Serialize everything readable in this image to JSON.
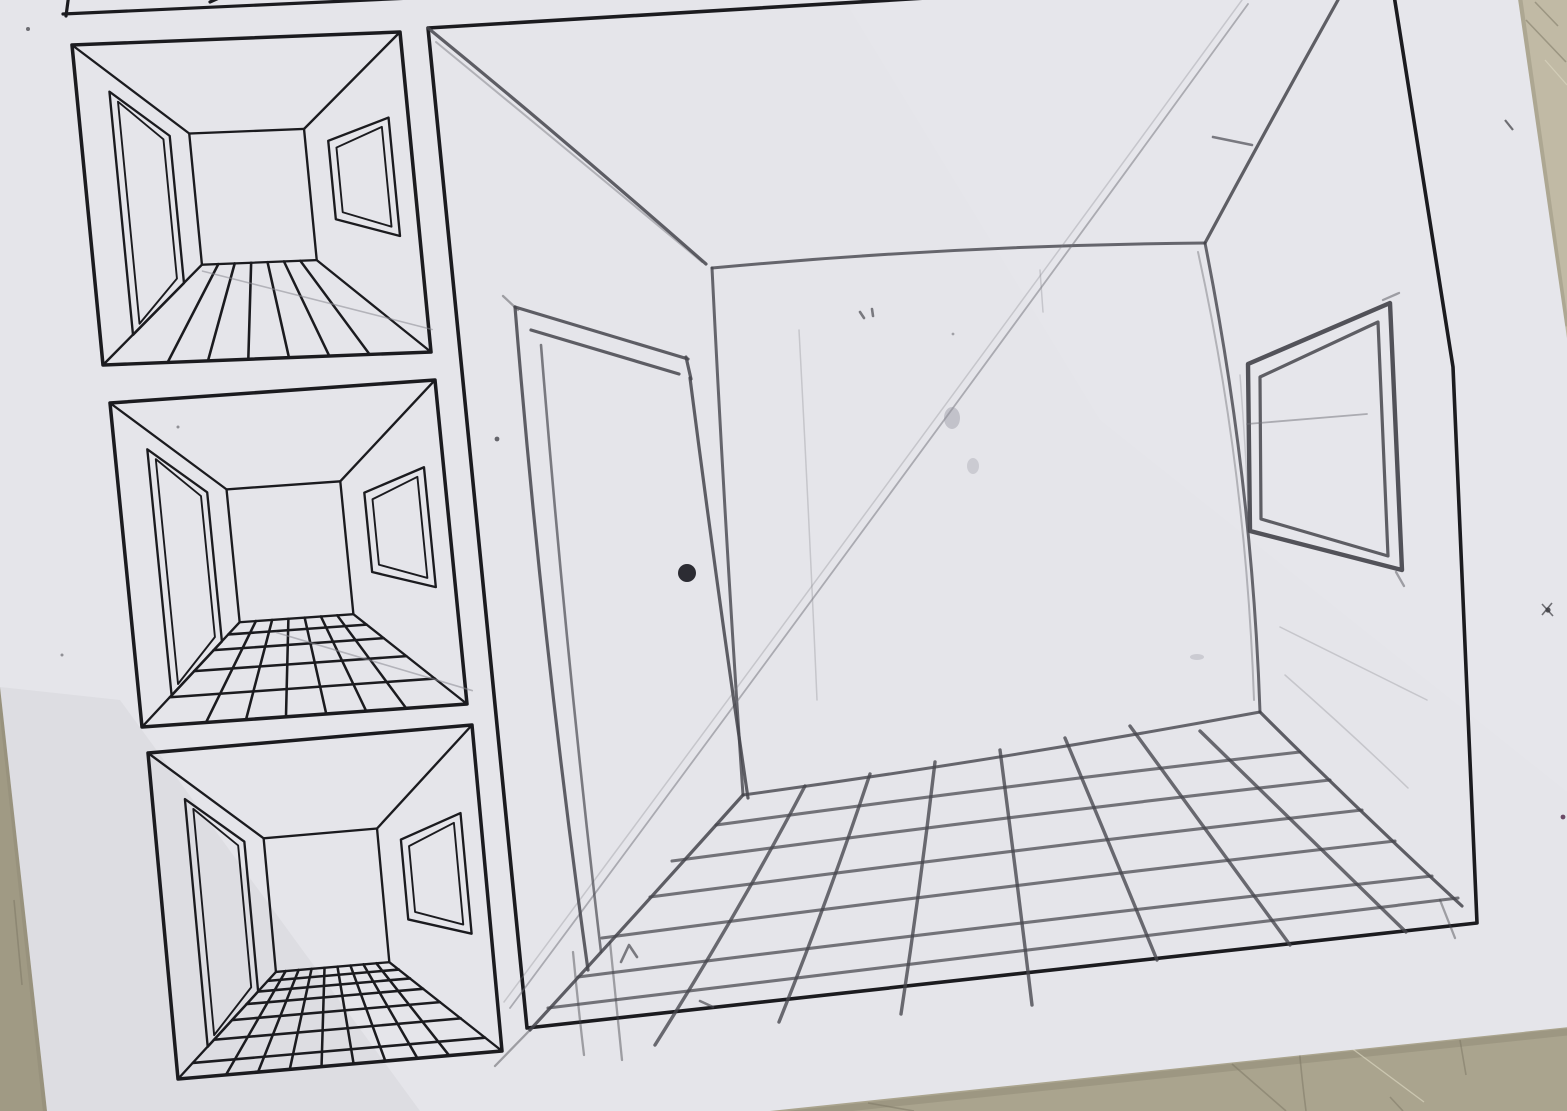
{
  "scene": {
    "description": "Photograph of a one-point perspective drawing worksheet lying on a table",
    "medium": "pencil on printed worksheet",
    "visible_text": ""
  },
  "colors": {
    "table": "#b7b19b",
    "table_dark": "#a09a84",
    "paper": "#e5e5ea",
    "paper_bright": "#eeeef2",
    "printed_ink": "#1b1b1f",
    "pencil": "#45454c",
    "pencil_faint": "#6f6f78",
    "purple_fleck": "#6b4a66"
  },
  "worksheet": {
    "cropped_panel_top": {
      "id": "cropped-top",
      "content": "bottom sliver of an example panel cut off by photo edge"
    },
    "printed_example_panels": [
      {
        "id": "example-1",
        "room": "one-point perspective room with left door and right window",
        "floor": "floorboards radiating to vanishing point"
      },
      {
        "id": "example-2",
        "room": "one-point perspective room with left door and right window",
        "floor": "coarse tile grid"
      },
      {
        "id": "example-3",
        "room": "one-point perspective room with left door and right window",
        "floor": "fine tile grid"
      }
    ],
    "practice_panel": {
      "id": "practice",
      "border": "printed",
      "drawing": "hand-drawn pencil room",
      "elements": [
        "back wall",
        "ceiling corner diagonals",
        "door with doorknob on left wall",
        "double-frame window on right wall",
        "tiled floor grid",
        "long construction diagonal",
        "stray pencil marks and smudges"
      ]
    }
  }
}
